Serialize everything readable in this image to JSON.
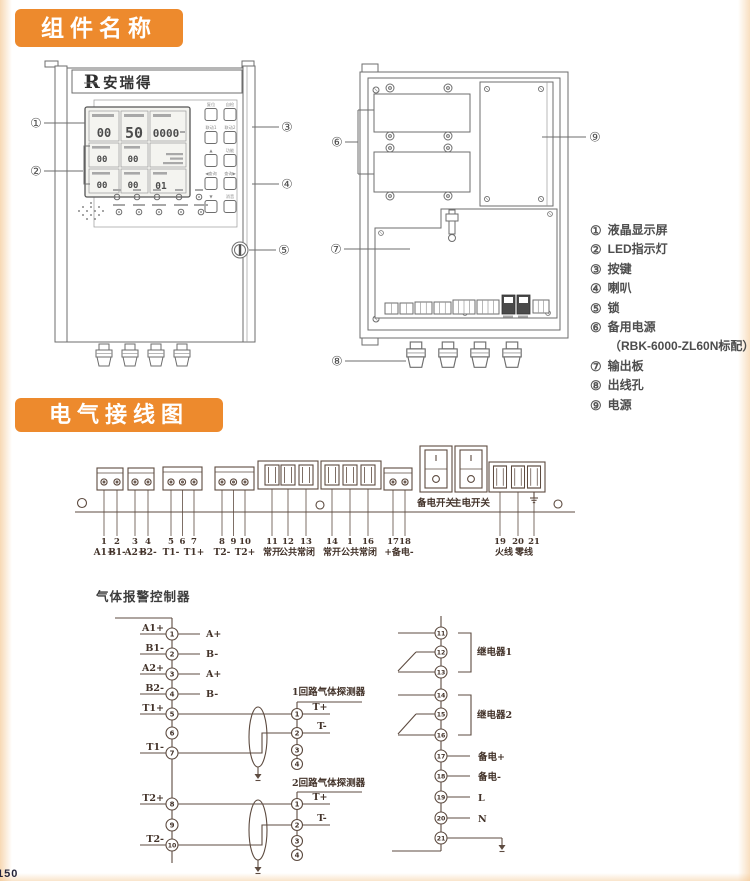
{
  "page": {
    "footer_page_number": "150"
  },
  "sections": {
    "components_title": "组件名称",
    "wiring_title": "电气接线图"
  },
  "front_panel": {
    "brand_logo": "R",
    "brand_name": "安瑞得",
    "lcd": {
      "row1": [
        "00",
        "50",
        "0000"
      ],
      "row2": [
        "00",
        "00"
      ],
      "row3": [
        "00",
        "00"
      ],
      "channel": "01"
    },
    "buttons": [
      "复位",
      "自检",
      "联动1",
      "联动2",
      "▲",
      "功能",
      "◀查询",
      "查询▶",
      "▼",
      "消音"
    ]
  },
  "callouts": [
    "①",
    "②",
    "③",
    "④",
    "⑤",
    "⑥",
    "⑦",
    "⑧",
    "⑨"
  ],
  "legend": [
    {
      "num": "①",
      "label": "液晶显示屏"
    },
    {
      "num": "②",
      "label": "LED指示灯"
    },
    {
      "num": "③",
      "label": "按键"
    },
    {
      "num": "④",
      "label": "喇叭"
    },
    {
      "num": "⑤",
      "label": "锁"
    },
    {
      "num": "⑥",
      "label": "备用电源",
      "note": "（RBK-6000-ZL60N标配）"
    },
    {
      "num": "⑦",
      "label": "输出板"
    },
    {
      "num": "⑧",
      "label": "出线孔"
    },
    {
      "num": "⑨",
      "label": "电源"
    }
  ],
  "terminal_strip": {
    "numbers": [
      "1",
      "2",
      "3",
      "4",
      "5",
      "6",
      "7",
      "8",
      "9",
      "10",
      "11",
      "12",
      "13",
      "14",
      "1",
      "16",
      "17",
      "18",
      "19",
      "20",
      "21"
    ],
    "labels": [
      "A1+",
      "B1-",
      "A2+",
      "B2-",
      "T1-",
      "T1+",
      "T2-",
      "T2+",
      "常开",
      "公共",
      "常闭",
      "常开",
      "公共",
      "常闭",
      "+备电-",
      "火线",
      "零线"
    ],
    "switches": [
      "备电开关",
      "主电开关"
    ]
  },
  "schematic": {
    "title": "气体报警控制器",
    "left_nodes": [
      {
        "n": "1",
        "label": "A1+",
        "out": "A+"
      },
      {
        "n": "2",
        "label": "B1-",
        "out": "B-"
      },
      {
        "n": "3",
        "label": "A2+",
        "out": "A+"
      },
      {
        "n": "4",
        "label": "B2-",
        "out": "B-"
      },
      {
        "n": "5",
        "label": "T1+"
      },
      {
        "n": "6",
        "label": ""
      },
      {
        "n": "7",
        "label": "T1-"
      },
      {
        "n": "8",
        "label": "T2+"
      },
      {
        "n": "9",
        "label": ""
      },
      {
        "n": "10",
        "label": "T2-"
      }
    ],
    "detectors": [
      {
        "title": "1回路气体探测器",
        "pins": [
          "1",
          "2",
          "3",
          "4"
        ],
        "pin_labels": [
          "T+",
          "T-"
        ]
      },
      {
        "title": "2回路气体探测器",
        "pins": [
          "1",
          "2",
          "3",
          "4"
        ],
        "pin_labels": [
          "T+",
          "T-"
        ]
      }
    ],
    "right_nodes": [
      "11",
      "12",
      "13",
      "14",
      "15",
      "16",
      "17",
      "18",
      "19",
      "20",
      "21"
    ],
    "right_labels": {
      "n17": "备电+",
      "n18": "备电-",
      "n19": "L",
      "n20": "N"
    },
    "relays": [
      "继电器1",
      "继电器2"
    ]
  },
  "colors": {
    "accent_orange": "#ED8A2D",
    "device_line": "#6e6e6e",
    "wiring_line": "#5d4b40"
  }
}
